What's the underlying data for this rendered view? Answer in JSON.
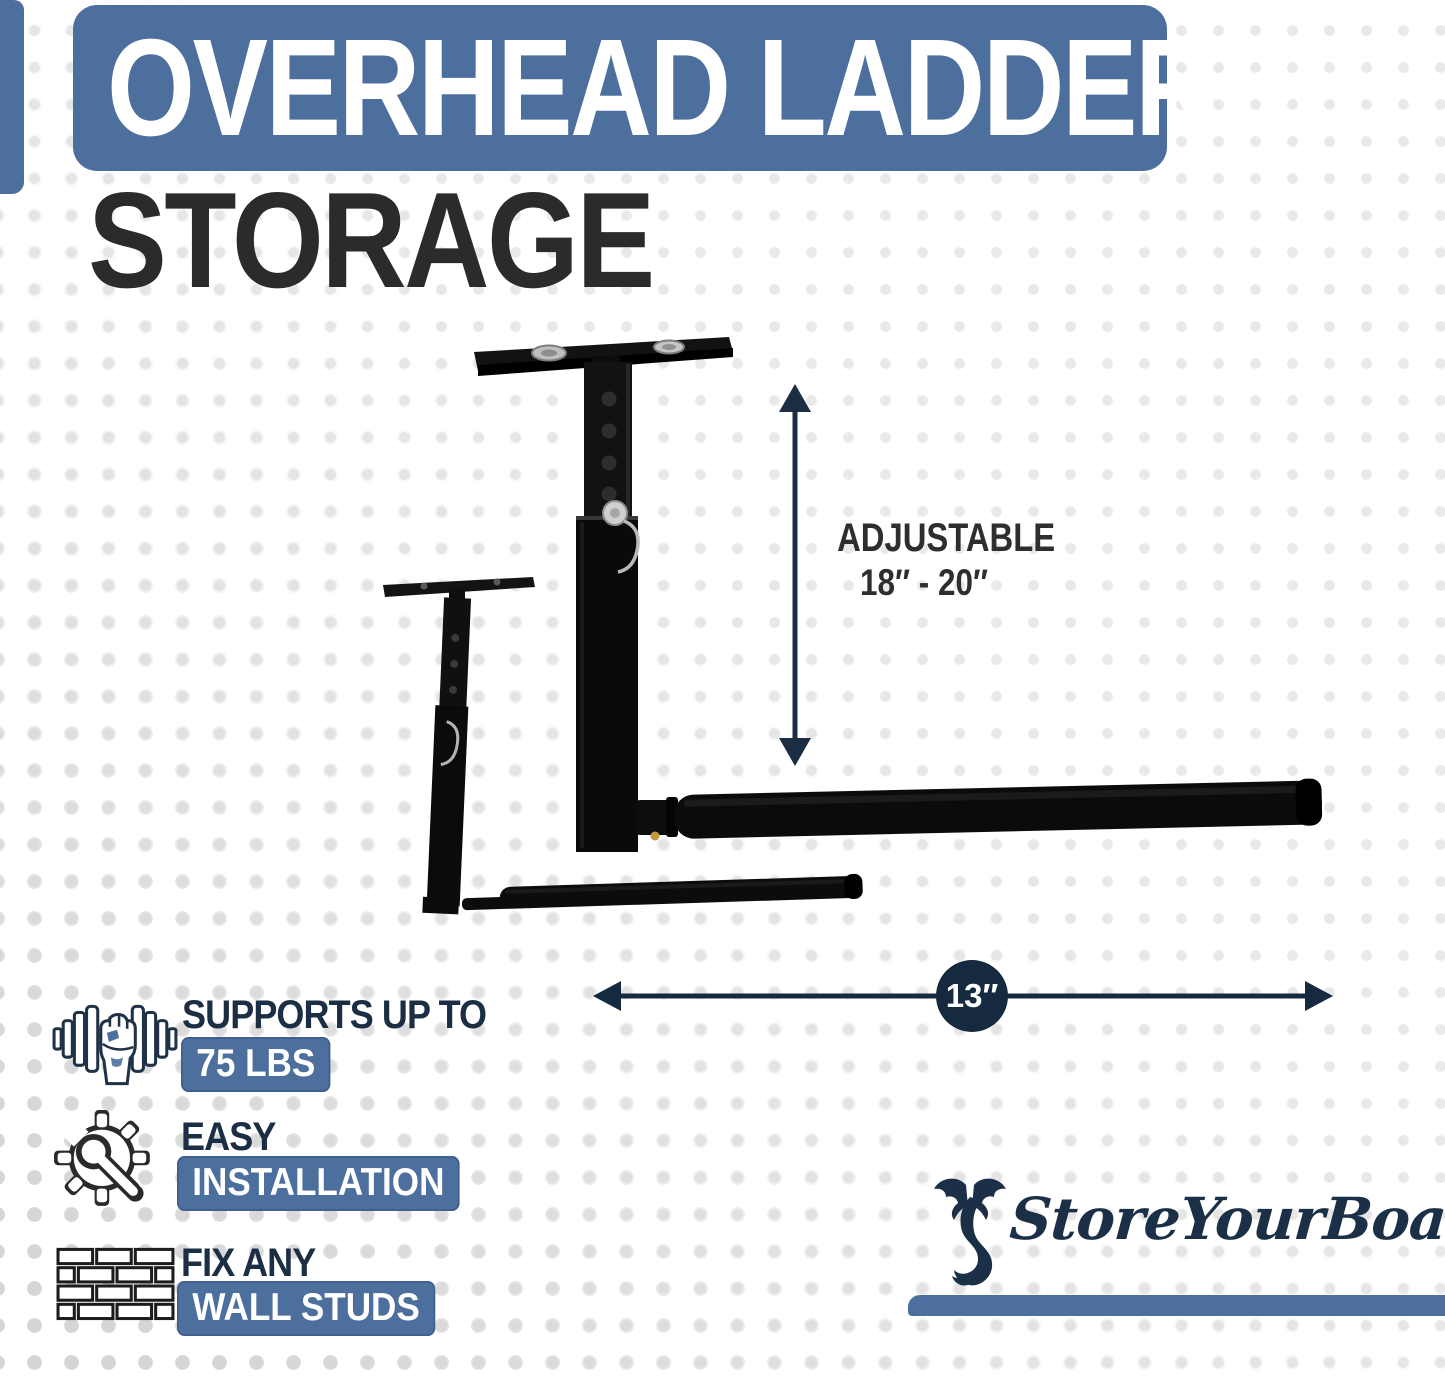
{
  "header": {
    "banner_title": "OVERHEAD LADDER",
    "subtitle": "STORAGE"
  },
  "diagram": {
    "adjustable_label": "ADJUSTABLE",
    "adjustable_range": "18″ - 20″",
    "width_label": "13″"
  },
  "features": [
    {
      "icon": "dumbbell-hand-icon",
      "heading": "SUPPORTS UP TO",
      "badge": "75 LBS"
    },
    {
      "icon": "gear-wrench-icon",
      "heading": "EASY",
      "badge": "INSTALLATION"
    },
    {
      "icon": "brick-wall-icon",
      "heading": "FIX ANY",
      "badge": "WALL STUDS"
    }
  ],
  "brand": {
    "name": "StoreYourBoard",
    "icon": "seahorse-dragon-icon"
  },
  "colors": {
    "accent_blue": "#4d6f9e",
    "badge_border": "#40608d",
    "navy": "#1c2e44",
    "dim_navy": "#152a3e",
    "ink": "#2b2b2b",
    "dot_light": "#e9e9e9",
    "dot_strong": "#d4d4d4",
    "product_black": "#0b0b0b",
    "white": "#ffffff"
  }
}
